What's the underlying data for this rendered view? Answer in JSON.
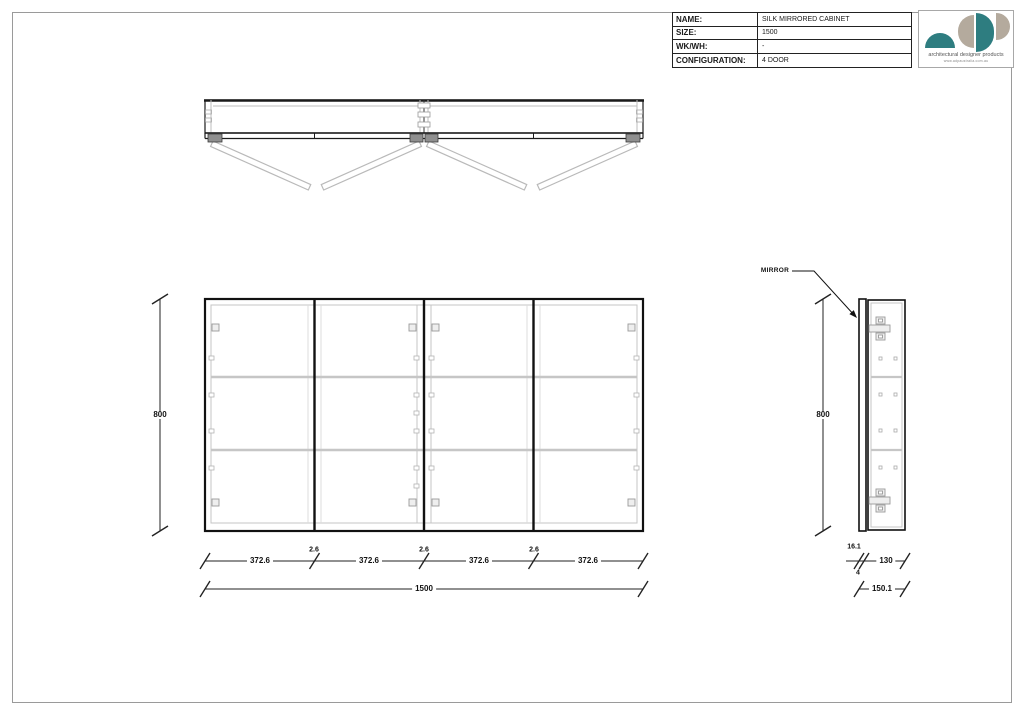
{
  "title_block": {
    "rows": [
      {
        "label": "NAME:",
        "value": "SILK MIRRORED CABINET"
      },
      {
        "label": "SIZE:",
        "value": "1500"
      },
      {
        "label": "WK/WH:",
        "value": "-"
      },
      {
        "label": "CONFIGURATION:",
        "value": "4 DOOR"
      }
    ]
  },
  "logo": {
    "tagline": "architectural designer products",
    "website": "www.adpaustralia.com.au",
    "colors": {
      "teal": "#2e7d80",
      "gray": "#b4aa9d"
    }
  },
  "views": {
    "front": {
      "height_label": "800",
      "door_widths": [
        "372.6",
        "372.6",
        "372.6",
        "372.6"
      ],
      "gap_labels": [
        "2.6",
        "2.6",
        "2.6"
      ],
      "overall_width": "1500"
    },
    "side": {
      "height_label": "800",
      "mirror_label": "MIRROR",
      "mirror_thickness": "16.1",
      "gap": "4",
      "carcass_depth": "130",
      "overall_depth": "150.1"
    }
  }
}
